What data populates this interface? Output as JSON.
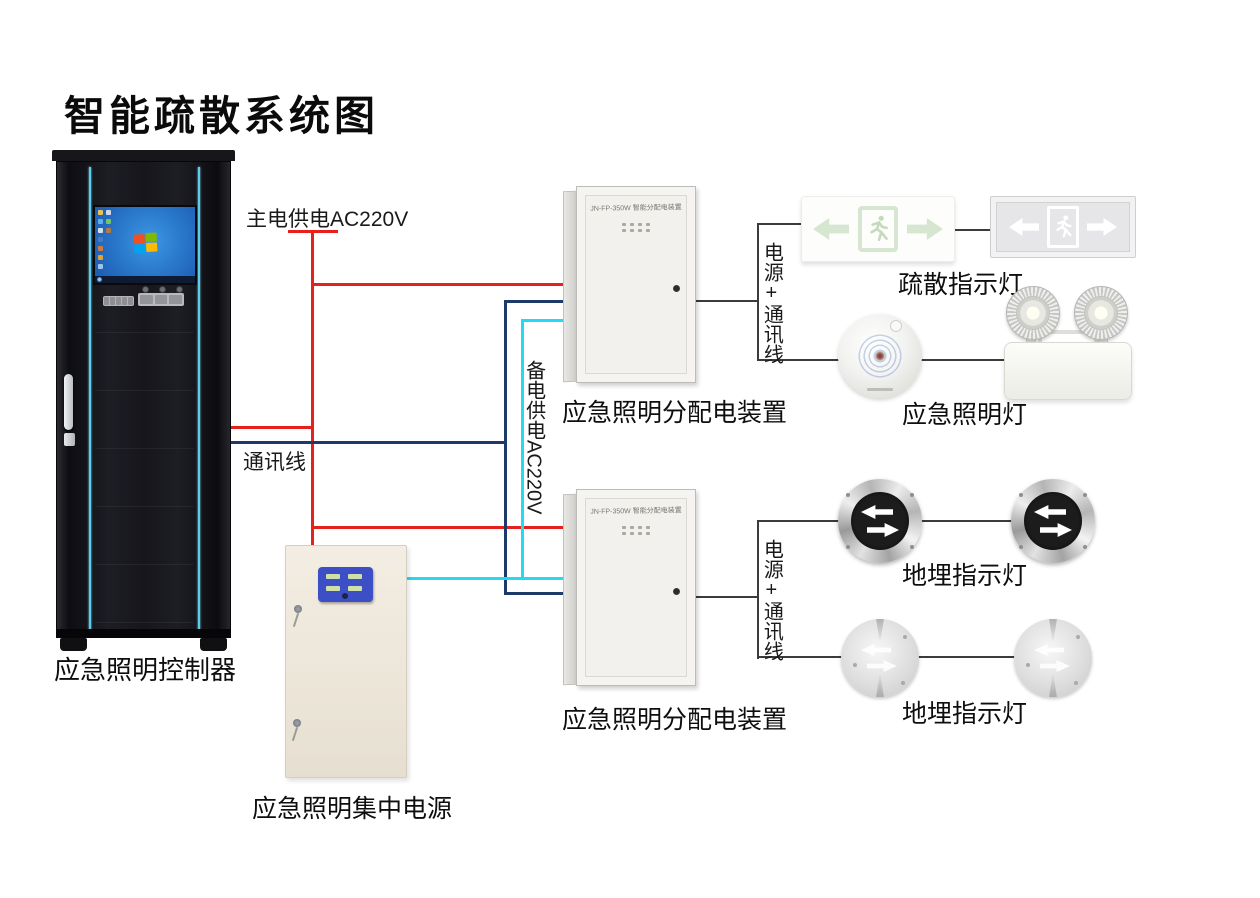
{
  "title": "智能疏散系统图",
  "controller": {
    "label": "应急照明控制器"
  },
  "central_power": {
    "label": "应急照明集中电源"
  },
  "distribution_boxes": {
    "box1": {
      "model": "JN-FP-350W 智能分配电装置",
      "label": "应急照明分配电装置"
    },
    "box2": {
      "model": "JN-FP-350W 智能分配电装置",
      "label": "应急照明分配电装置"
    }
  },
  "wire_labels": {
    "main_power": "主电供电AC220V",
    "comm": "通讯线",
    "backup_power": "备电供电AC220V",
    "branch1": "电源+通讯线",
    "branch2": "电源+通讯线"
  },
  "wire_colors": {
    "main_power": "#e8201d",
    "comm": "#1d3a68",
    "backup_power": "#25d9f2",
    "branch": "#3b3b3b"
  },
  "devices": {
    "exit_sign_group_label": "疏散指示灯",
    "emergency_light_label": "应急照明灯",
    "ground_light_group1_label": "地埋指示灯",
    "ground_light_group2_label": "地埋指示灯"
  }
}
